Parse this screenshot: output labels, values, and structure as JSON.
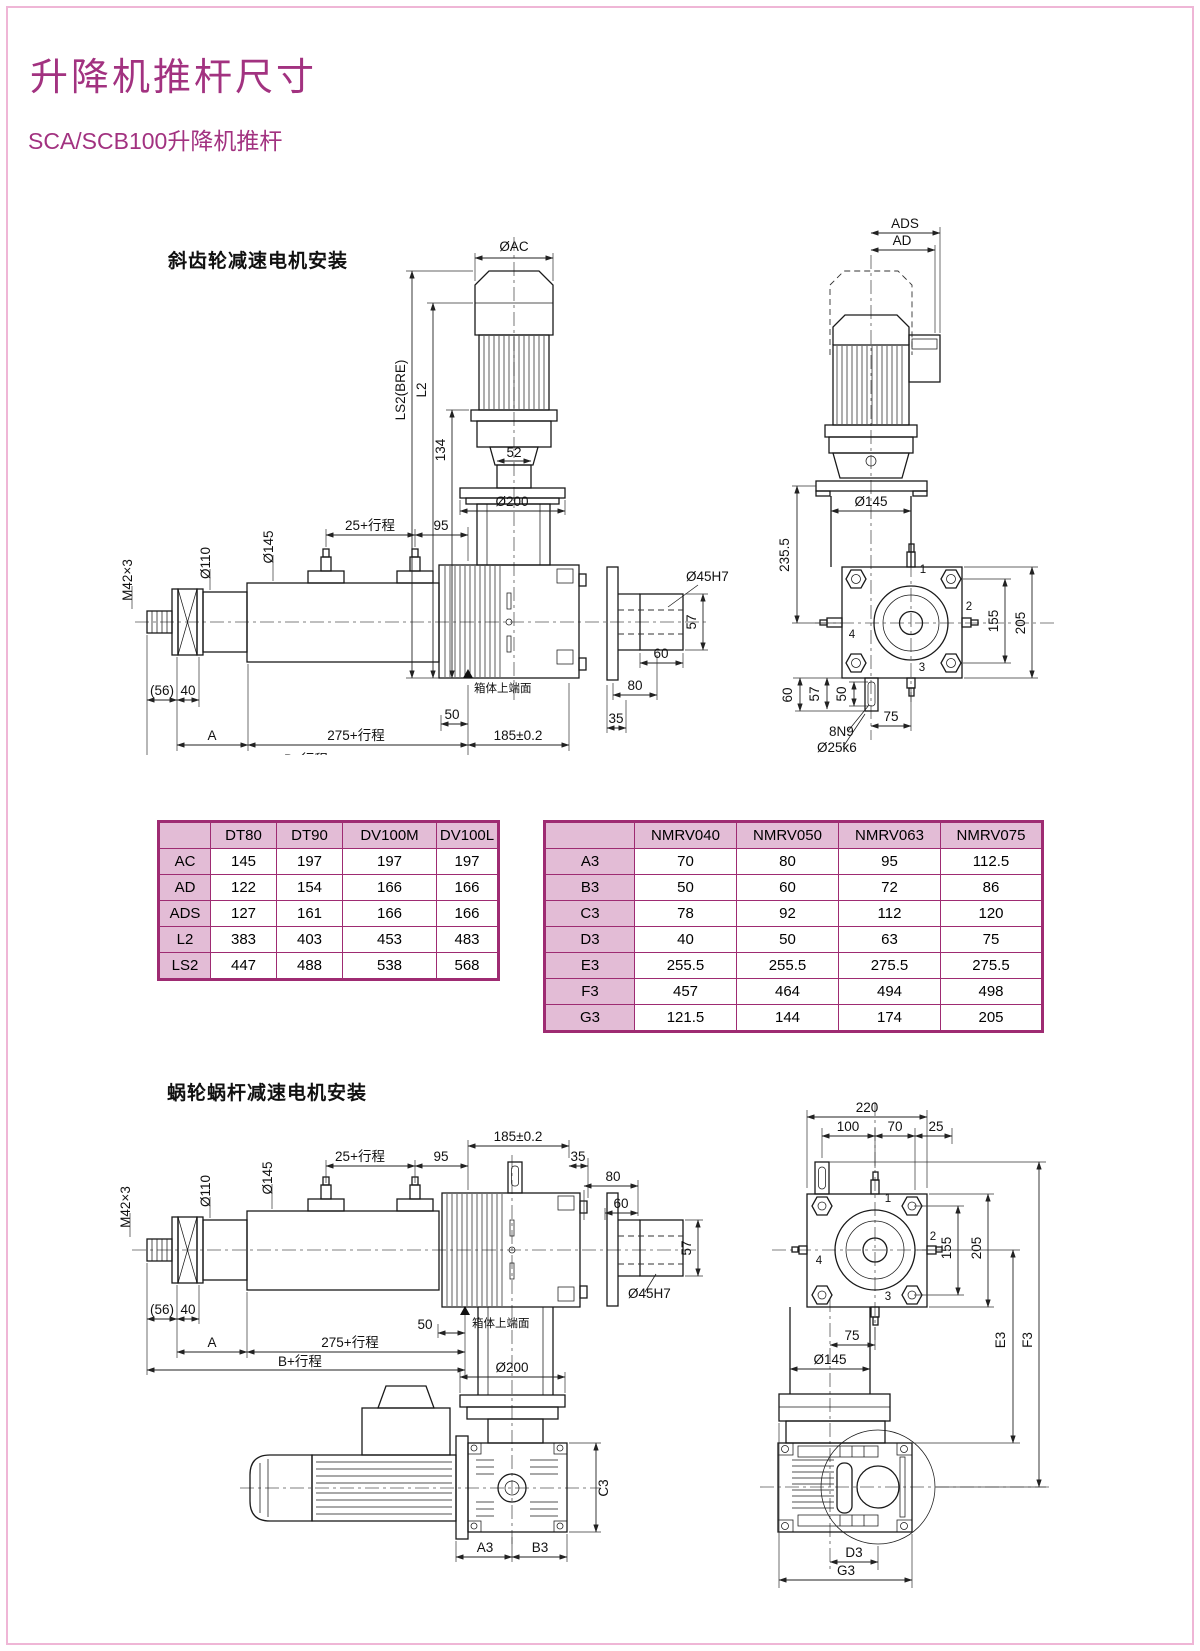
{
  "page": {
    "title": "升降机推杆尺寸",
    "subtitle": "SCA/SCB100升降机推杆",
    "accent_color": "#A23280",
    "table_border_color": "#9E2B72",
    "table_header_bg": "#E3BCD6"
  },
  "sections": {
    "helical_label": "斜齿轮减速电机安装",
    "worm_label": "蜗轮蜗杆减速电机安装"
  },
  "tables": {
    "motor": {
      "columns": [
        "",
        "DT80",
        "DT90",
        "DV100M",
        "DV100L"
      ],
      "rows": [
        [
          "AC",
          "145",
          "197",
          "197",
          "197"
        ],
        [
          "AD",
          "122",
          "154",
          "166",
          "166"
        ],
        [
          "ADS",
          "127",
          "161",
          "166",
          "166"
        ],
        [
          "L2",
          "383",
          "403",
          "453",
          "483"
        ],
        [
          "LS2",
          "447",
          "488",
          "538",
          "568"
        ]
      ]
    },
    "gearbox": {
      "columns": [
        "",
        "NMRV040",
        "NMRV050",
        "NMRV063",
        "NMRV075"
      ],
      "rows": [
        [
          "A3",
          "70",
          "80",
          "95",
          "112.5"
        ],
        [
          "B3",
          "50",
          "60",
          "72",
          "86"
        ],
        [
          "C3",
          "78",
          "92",
          "112",
          "120"
        ],
        [
          "D3",
          "40",
          "50",
          "63",
          "75"
        ],
        [
          "E3",
          "255.5",
          "255.5",
          "275.5",
          "275.5"
        ],
        [
          "F3",
          "457",
          "464",
          "494",
          "498"
        ],
        [
          "G3",
          "121.5",
          "144",
          "174",
          "205"
        ]
      ]
    }
  },
  "drawings": {
    "helical_side": {
      "oac": "ØAC",
      "ls2": "LS2(BRE)",
      "l2": "L2",
      "n134": "134",
      "n52": "52",
      "o200": "Ø200",
      "s25": "25+行程",
      "n95": "95",
      "o145": "Ø145",
      "o110": "Ø110",
      "m42": "M42×3",
      "n56": "(56)",
      "n40": "40",
      "a": "A",
      "s275": "275+行程",
      "b": "B+行程",
      "n50": "50",
      "face": "箱体上端面",
      "n185": "185±0.2",
      "o45": "Ø45H7",
      "n57": "57",
      "n60": "60",
      "n80": "80",
      "n35": "35"
    },
    "helical_end": {
      "ads": "ADS",
      "ad": "AD",
      "o145": "Ø145",
      "n2355": "235.5",
      "n155": "155",
      "n205": "205",
      "n60": "60",
      "n57": "57",
      "n50": "50",
      "n75": "75",
      "k8n9": "8N9",
      "o25k6": "Ø25k6",
      "p1": "1",
      "p2": "2",
      "p3": "3",
      "p4": "4"
    },
    "worm_side": {
      "n185": "185±0.2",
      "s25": "25+行程",
      "n95": "95",
      "n35": "35",
      "n80": "80",
      "n60": "60",
      "n57": "57",
      "o45": "Ø45H7",
      "o110": "Ø110",
      "o145": "Ø145",
      "m42": "M42×3",
      "n56": "(56)",
      "n40": "40",
      "a": "A",
      "s275": "275+行程",
      "b": "B+行程",
      "n50": "50",
      "face": "箱体上端面",
      "o200": "Ø200",
      "c3": "C3",
      "a3": "A3",
      "b3": "B3"
    },
    "worm_end": {
      "n220": "220",
      "n100": "100",
      "n70": "70",
      "n25": "25",
      "n155": "155",
      "n205": "205",
      "n75": "75",
      "o145": "Ø145",
      "e3": "E3",
      "f3": "F3",
      "d3": "D3",
      "g3": "G3",
      "p1": "1",
      "p2": "2",
      "p3": "3",
      "p4": "4"
    }
  }
}
